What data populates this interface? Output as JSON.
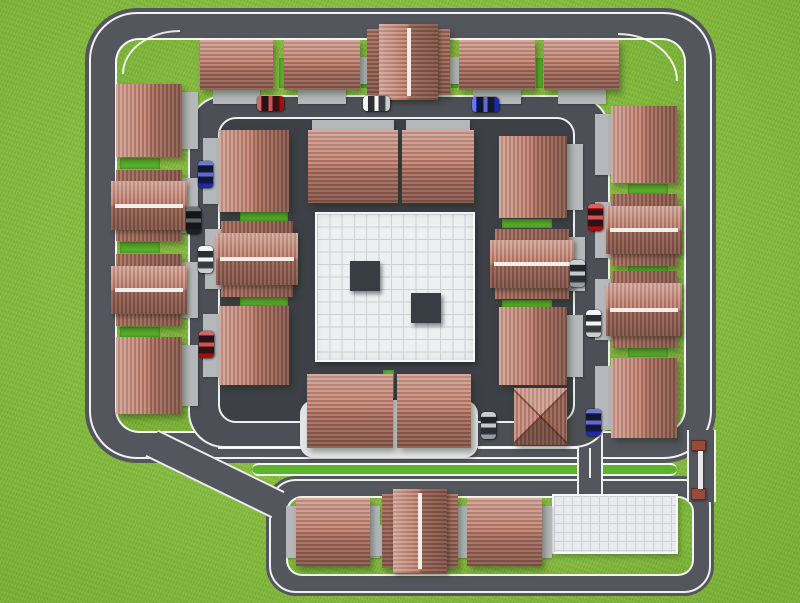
{
  "scene": {
    "title": "Residential compound site plan - 3D aerial render",
    "description": "Top-down 3D render of a gated residential compound: outer and inner ring roads, terracotta-roof houses, parked cars, a central white tiled plaza with two dark blocks, a lower annex with three houses and a parking lot, and an entrance gate with red posts."
  },
  "colors": {
    "grass": "#8ac43f",
    "road": "#53565c",
    "road2": "#4c5056",
    "pavement": "#3d4147",
    "pad": "#b5b8ba",
    "platform": "#e3e6e8",
    "plaza": "#edeff0",
    "plaza_line": "#ccd1d5",
    "block": "#383d43",
    "parking": "#e8ebed",
    "hedge": "#5cb32c",
    "tl": "#c98d7b",
    "td": "#a5695b",
    "ridge": "#f1eeea",
    "gate_post": "#9a4a3b",
    "gate_bar": "#e9e9e9",
    "car_red": "#c40f0f",
    "car_blue": "#2030c8",
    "car_white": "#eef1f3",
    "car_silver": "#aeb6bd",
    "car_dark": "#23262b"
  },
  "plaza": {
    "x": 315,
    "y": 212,
    "w": 160,
    "h": 150,
    "blocks": [
      {
        "x": 33,
        "y": 47,
        "w": 30,
        "h": 30
      },
      {
        "x": 94,
        "y": 79,
        "w": 30,
        "h": 30
      }
    ]
  },
  "parking": {
    "x": 552,
    "y": 494,
    "w": 126,
    "h": 60
  },
  "platform": {
    "x": 300,
    "y": 400,
    "w": 178,
    "h": 58
  },
  "houses": [
    {
      "x": 200,
      "y": 40,
      "w": 73,
      "h": 50,
      "v": "ph",
      "pad": "below"
    },
    {
      "x": 284,
      "y": 40,
      "w": 76,
      "h": 50,
      "v": "ph",
      "pad": "below"
    },
    {
      "x": 367,
      "y": 29,
      "w": 83,
      "h": 66,
      "v": "twov",
      "pad": "wings"
    },
    {
      "x": 459,
      "y": 40,
      "w": 76,
      "h": 50,
      "v": "ph",
      "pad": "below"
    },
    {
      "x": 544,
      "y": 40,
      "w": 75,
      "h": 50,
      "v": "ph",
      "pad": "below"
    },
    {
      "x": 116,
      "y": 84,
      "w": 66,
      "h": 73,
      "v": "pv",
      "pad": "right"
    },
    {
      "x": 116,
      "y": 170,
      "w": 66,
      "h": 71,
      "v": "twoh",
      "pad": "right"
    },
    {
      "x": 116,
      "y": 254,
      "w": 66,
      "h": 72,
      "v": "twoh",
      "pad": "right"
    },
    {
      "x": 116,
      "y": 337,
      "w": 66,
      "h": 77,
      "v": "pv",
      "pad": "right"
    },
    {
      "x": 611,
      "y": 106,
      "w": 66,
      "h": 77,
      "v": "pv",
      "pad": "left"
    },
    {
      "x": 611,
      "y": 194,
      "w": 66,
      "h": 72,
      "v": "twoh",
      "pad": "left"
    },
    {
      "x": 611,
      "y": 271,
      "w": 66,
      "h": 77,
      "v": "twoh",
      "pad": "left"
    },
    {
      "x": 611,
      "y": 358,
      "w": 66,
      "h": 80,
      "v": "pv",
      "pad": "left"
    },
    {
      "x": 219,
      "y": 130,
      "w": 70,
      "h": 82,
      "v": "pv",
      "pad": "left"
    },
    {
      "x": 221,
      "y": 221,
      "w": 72,
      "h": 76,
      "v": "twoh",
      "pad": "left"
    },
    {
      "x": 219,
      "y": 306,
      "w": 70,
      "h": 79,
      "v": "pv",
      "pad": "left"
    },
    {
      "x": 308,
      "y": 130,
      "w": 90,
      "h": 73,
      "v": "ph",
      "pad": "above"
    },
    {
      "x": 402,
      "y": 130,
      "w": 72,
      "h": 73,
      "v": "ph",
      "pad": "above"
    },
    {
      "x": 499,
      "y": 136,
      "w": 68,
      "h": 82,
      "v": "pv",
      "pad": "right"
    },
    {
      "x": 495,
      "y": 229,
      "w": 74,
      "h": 70,
      "v": "twoh",
      "pad": "right"
    },
    {
      "x": 499,
      "y": 307,
      "w": 68,
      "h": 78,
      "v": "pv",
      "pad": "right"
    },
    {
      "x": 514,
      "y": 388,
      "w": 53,
      "h": 57,
      "v": "hipx",
      "pad": "none"
    },
    {
      "x": 307,
      "y": 374,
      "w": 86,
      "h": 74,
      "v": "ph",
      "pad": "none"
    },
    {
      "x": 397,
      "y": 374,
      "w": 74,
      "h": 74,
      "v": "ph",
      "pad": "none"
    },
    {
      "x": 296,
      "y": 498,
      "w": 74,
      "h": 68,
      "v": "ph",
      "pad": "sides"
    },
    {
      "x": 382,
      "y": 494,
      "w": 76,
      "h": 74,
      "v": "twov",
      "pad": "wings"
    },
    {
      "x": 467,
      "y": 498,
      "w": 75,
      "h": 68,
      "v": "ph",
      "pad": "sides"
    }
  ],
  "cars": [
    {
      "x": 257,
      "y": 96,
      "o": "h",
      "c": "red"
    },
    {
      "x": 363,
      "y": 96,
      "o": "h",
      "c": "white"
    },
    {
      "x": 472,
      "y": 97,
      "o": "h",
      "c": "blue"
    },
    {
      "x": 198,
      "y": 161,
      "o": "v",
      "c": "blue"
    },
    {
      "x": 186,
      "y": 207,
      "o": "v",
      "c": "dark"
    },
    {
      "x": 198,
      "y": 246,
      "o": "v",
      "c": "white"
    },
    {
      "x": 199,
      "y": 331,
      "o": "v",
      "c": "red"
    },
    {
      "x": 588,
      "y": 204,
      "o": "v",
      "c": "red"
    },
    {
      "x": 570,
      "y": 260,
      "o": "v",
      "c": "silver"
    },
    {
      "x": 586,
      "y": 310,
      "o": "v",
      "c": "white"
    },
    {
      "x": 481,
      "y": 412,
      "o": "v",
      "c": "silver"
    },
    {
      "x": 586,
      "y": 409,
      "o": "v",
      "c": "blue"
    }
  ],
  "hedges": [
    {
      "x": 279,
      "y": 58,
      "w": 8,
      "h": 30
    },
    {
      "x": 361,
      "y": 58,
      "w": 7,
      "h": 30
    },
    {
      "x": 451,
      "y": 58,
      "w": 7,
      "h": 30
    },
    {
      "x": 536,
      "y": 58,
      "w": 7,
      "h": 30
    },
    {
      "x": 120,
      "y": 158,
      "w": 40,
      "h": 11
    },
    {
      "x": 120,
      "y": 242,
      "w": 40,
      "h": 11
    },
    {
      "x": 120,
      "y": 327,
      "w": 40,
      "h": 10
    },
    {
      "x": 628,
      "y": 184,
      "w": 40,
      "h": 10
    },
    {
      "x": 628,
      "y": 266,
      "w": 40,
      "h": 9
    },
    {
      "x": 628,
      "y": 348,
      "w": 40,
      "h": 9
    },
    {
      "x": 240,
      "y": 212,
      "w": 48,
      "h": 9
    },
    {
      "x": 240,
      "y": 297,
      "w": 48,
      "h": 9
    },
    {
      "x": 502,
      "y": 219,
      "w": 50,
      "h": 9
    },
    {
      "x": 502,
      "y": 300,
      "w": 50,
      "h": 8
    },
    {
      "x": 386,
      "y": 178,
      "w": 12,
      "h": 24
    },
    {
      "x": 383,
      "y": 370,
      "w": 11,
      "h": 28
    }
  ],
  "gate": {
    "posts": [
      {
        "x": 691,
        "y": 440,
        "w": 15,
        "h": 11
      },
      {
        "x": 691,
        "y": 488,
        "w": 15,
        "h": 12
      }
    ],
    "bar": {
      "x": 698,
      "y": 451,
      "w": 5,
      "h": 38
    }
  }
}
